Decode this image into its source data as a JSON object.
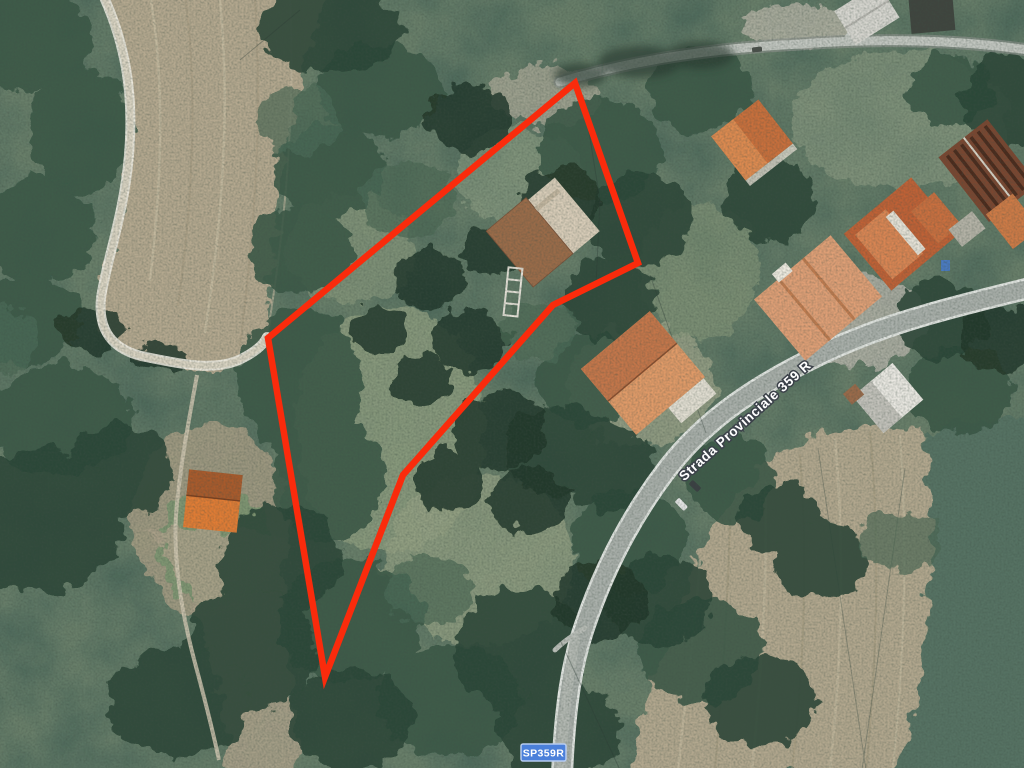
{
  "view": {
    "description": "Aerial satellite view of a rural hillside with forest, plowed fields, houses and a provincial road; a red outline marks a land parcel for sale"
  },
  "labels": {
    "road_name": "Strada Provinciale 359 R",
    "route_badge": "SP359R"
  },
  "overlay": {
    "parcel_polygon_points": "575,83 638,263 553,305 403,475 325,677 268,338",
    "color": "#fa2b0c",
    "stroke_width": 6.5
  },
  "badge": {
    "background": "#4b80da",
    "border": "#b6cbf0",
    "text_color": "#ffffff"
  },
  "road_label_style": {
    "text_color": "#ffffff",
    "outline_color": "#3c424a"
  },
  "terrain_colors": {
    "forest_dark": "#2c4637",
    "forest_mid": "#3a5848",
    "ground_sage": "#8fa088",
    "field_tan": "#b4a88f",
    "meadow_teal": "#567264",
    "road_asphalt": "#a9afaa",
    "road_casing": "#e3e6e2",
    "dirt_track": "#d9d3c2",
    "roof_orange": "#c4764a",
    "roof_salmon": "#df9f76",
    "roof_brown": "#9a6b49"
  }
}
